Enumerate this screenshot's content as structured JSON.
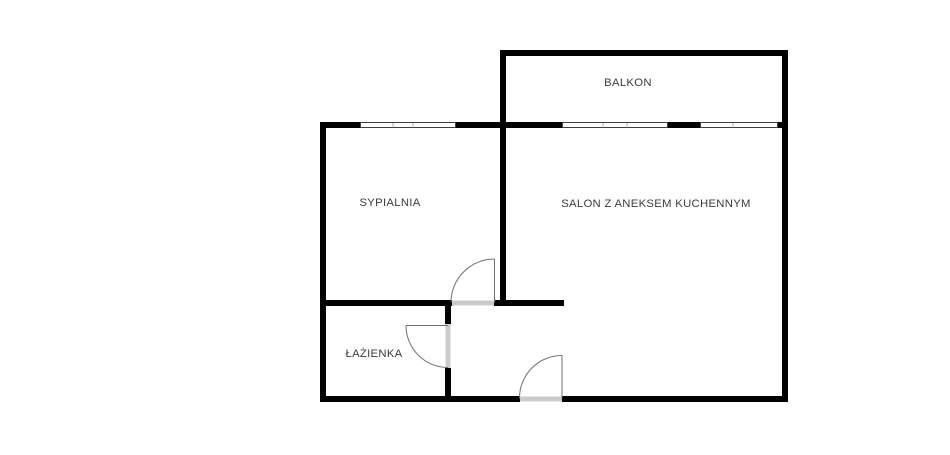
{
  "floorplan": {
    "type": "apartment-floor-plan",
    "rooms": {
      "balkon": {
        "label": "BALKON"
      },
      "sypialnia": {
        "label": "SYPIALNIA"
      },
      "salon": {
        "label": "SALON Z ANEKSEM KUCHENNYM"
      },
      "lazienka": {
        "label": "ŁAŻIENKA"
      }
    },
    "doors": [
      {
        "name": "sypialnia-door",
        "swing": "into-bedroom"
      },
      {
        "name": "lazienka-door",
        "swing": "into-bathroom"
      },
      {
        "name": "entrance-door",
        "swing": "into-hall"
      }
    ],
    "windows": [
      {
        "name": "sypialnia-window",
        "panes": 3
      },
      {
        "name": "salon-window-left",
        "panes": 3
      },
      {
        "name": "salon-window-right",
        "panes": 2
      }
    ],
    "colors": {
      "wall": "#000000",
      "background": "#ffffff",
      "door_line": "#6f6f6f",
      "threshold": "#cbcbcb",
      "window_outline": "#3d3d3d",
      "label_text": "#3b3b3b"
    }
  }
}
